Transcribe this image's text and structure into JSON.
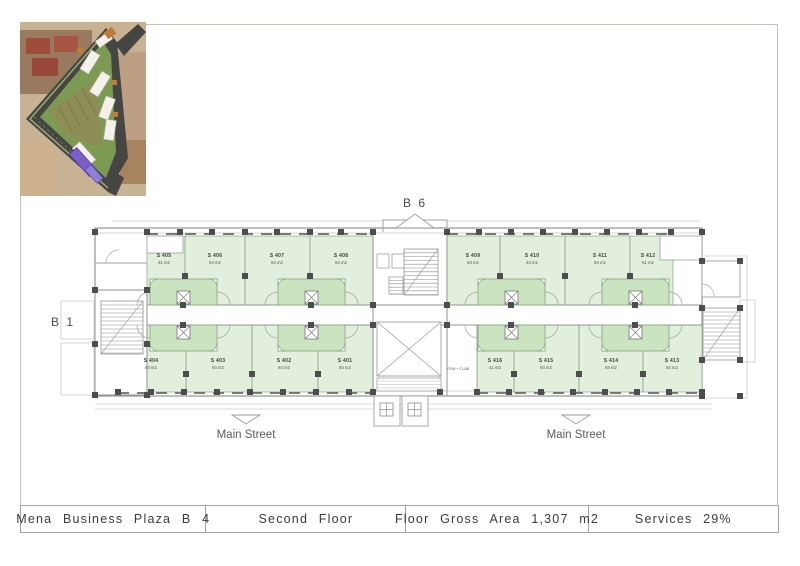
{
  "title_bar": {
    "project": "Mena  Business  Plaza  B 4",
    "floor": "Second  Floor",
    "gross_area": "Floor  Gross  Area 1,307 m2",
    "services": "Services  29%"
  },
  "plan": {
    "building_label_top": "B 6",
    "building_label_left": "B 1",
    "street_label": "Main Street",
    "gym_label": "GYM + CLUB",
    "units": [
      {
        "id": "S 405",
        "area": "61 m2"
      },
      {
        "id": "S 406",
        "area": "84 m2"
      },
      {
        "id": "S 407",
        "area": "84 m2"
      },
      {
        "id": "S 408",
        "area": "84 m2"
      },
      {
        "id": "S 409",
        "area": "84 m2"
      },
      {
        "id": "S 410",
        "area": "84 m2"
      },
      {
        "id": "S 411",
        "area": "84 m2"
      },
      {
        "id": "S 412",
        "area": "61 m2"
      },
      {
        "id": "S 404",
        "area": "84 m2"
      },
      {
        "id": "S 403",
        "area": "84 m2"
      },
      {
        "id": "S 402",
        "area": "84 m2"
      },
      {
        "id": "S 401",
        "area": "84 m2"
      },
      {
        "id": "S 416",
        "area": "41 m2"
      },
      {
        "id": "S 415",
        "area": "84 m2"
      },
      {
        "id": "S 414",
        "area": "84 m2"
      },
      {
        "id": "S 413",
        "area": "84 m2"
      }
    ],
    "colors": {
      "unit_fill": "#e1efdc",
      "bay_fill": "#c9e4bf",
      "wall_line": "#8f968f",
      "column": "#4d4d4d",
      "highlight_building": "#7a5fc9"
    }
  }
}
